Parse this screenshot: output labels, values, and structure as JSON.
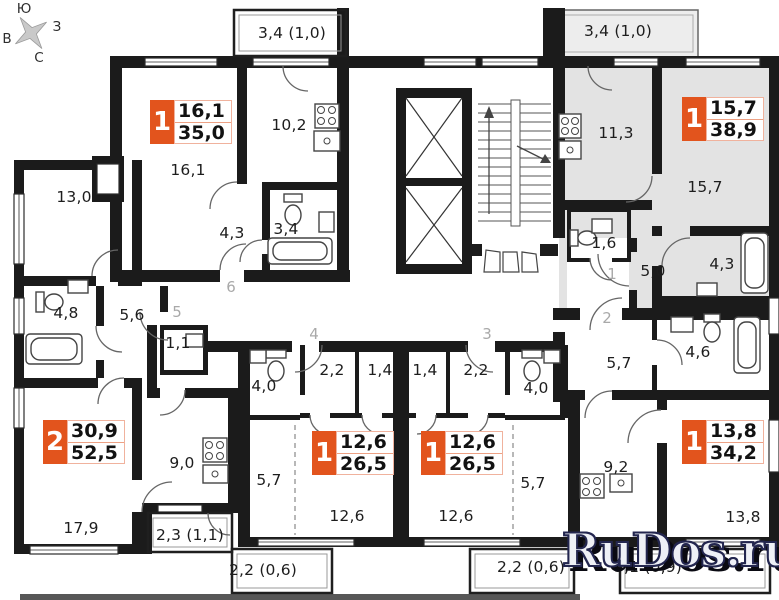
{
  "compass": {
    "top": "Ю",
    "right": "З",
    "bottom": "С",
    "left": "В"
  },
  "watermark": {
    "text": "RuDos.ru",
    "fill": "#eef0f6",
    "outline": "#23264f",
    "shadow": "#0a0a12"
  },
  "colors": {
    "badge_red": "#e2541d",
    "apartment_highlight": "#e3e3e3",
    "walls": "#1b1b1b",
    "corridor_number": "#a9a9a9"
  },
  "apartments": [
    {
      "rooms": "1",
      "area_living": "16,1",
      "area_total": "35,0",
      "x": 150,
      "y": 100
    },
    {
      "rooms": "1",
      "area_living": "15,7",
      "area_total": "38,9",
      "x": 682,
      "y": 97
    },
    {
      "rooms": "2",
      "area_living": "30,9",
      "area_total": "52,5",
      "x": 43,
      "y": 420
    },
    {
      "rooms": "1",
      "area_living": "12,6",
      "area_total": "26,5",
      "x": 312,
      "y": 431
    },
    {
      "rooms": "1",
      "area_living": "12,6",
      "area_total": "26,5",
      "x": 421,
      "y": 431
    },
    {
      "rooms": "1",
      "area_living": "13,8",
      "area_total": "34,2",
      "x": 682,
      "y": 420
    }
  ],
  "room_labels": [
    {
      "text": "3,4 (1,0)",
      "x": 292,
      "y": 33
    },
    {
      "text": "3,4 (1,0)",
      "x": 618,
      "y": 31
    },
    {
      "text": "16,1",
      "x": 188,
      "y": 170
    },
    {
      "text": "10,2",
      "x": 289,
      "y": 125
    },
    {
      "text": "11,3",
      "x": 616,
      "y": 133
    },
    {
      "text": "15,7",
      "x": 705,
      "y": 187
    },
    {
      "text": "13,0",
      "x": 74,
      "y": 197
    },
    {
      "text": "4,3",
      "x": 232,
      "y": 233
    },
    {
      "text": "3,4",
      "x": 286,
      "y": 229
    },
    {
      "text": "1,6",
      "x": 604,
      "y": 243
    },
    {
      "text": "5,0",
      "x": 653,
      "y": 271
    },
    {
      "text": "4,3",
      "x": 722,
      "y": 264
    },
    {
      "text": "4,8",
      "x": 66,
      "y": 313
    },
    {
      "text": "5,6",
      "x": 132,
      "y": 315
    },
    {
      "text": "1,1",
      "x": 178,
      "y": 343
    },
    {
      "text": "4,6",
      "x": 698,
      "y": 352
    },
    {
      "text": "5,7",
      "x": 619,
      "y": 363
    },
    {
      "text": "2,2",
      "x": 332,
      "y": 370
    },
    {
      "text": "1,4",
      "x": 380,
      "y": 370
    },
    {
      "text": "1,4",
      "x": 425,
      "y": 370
    },
    {
      "text": "2,2",
      "x": 476,
      "y": 370
    },
    {
      "text": "4,0",
      "x": 264,
      "y": 386
    },
    {
      "text": "4,0",
      "x": 536,
      "y": 388
    },
    {
      "text": "9,0",
      "x": 182,
      "y": 463
    },
    {
      "text": "9,2",
      "x": 616,
      "y": 467
    },
    {
      "text": "5,7",
      "x": 269,
      "y": 480
    },
    {
      "text": "5,7",
      "x": 533,
      "y": 483
    },
    {
      "text": "12,6",
      "x": 347,
      "y": 516
    },
    {
      "text": "12,6",
      "x": 456,
      "y": 516
    },
    {
      "text": "13,8",
      "x": 743,
      "y": 517
    },
    {
      "text": "17,9",
      "x": 81,
      "y": 528
    },
    {
      "text": "2,3 (1,1)",
      "x": 190,
      "y": 535
    },
    {
      "text": "2,2 (0,6)",
      "x": 263,
      "y": 570
    },
    {
      "text": "2,2 (0,6)",
      "x": 531,
      "y": 567
    },
    {
      "text": "3,1 (0,9)",
      "x": 648,
      "y": 567
    }
  ],
  "corridor_numbers": [
    {
      "text": "6",
      "x": 231,
      "y": 287
    },
    {
      "text": "5",
      "x": 177,
      "y": 312
    },
    {
      "text": "4",
      "x": 314,
      "y": 334
    },
    {
      "text": "3",
      "x": 487,
      "y": 334
    },
    {
      "text": "1",
      "x": 612,
      "y": 274
    },
    {
      "text": "2",
      "x": 607,
      "y": 318
    }
  ]
}
